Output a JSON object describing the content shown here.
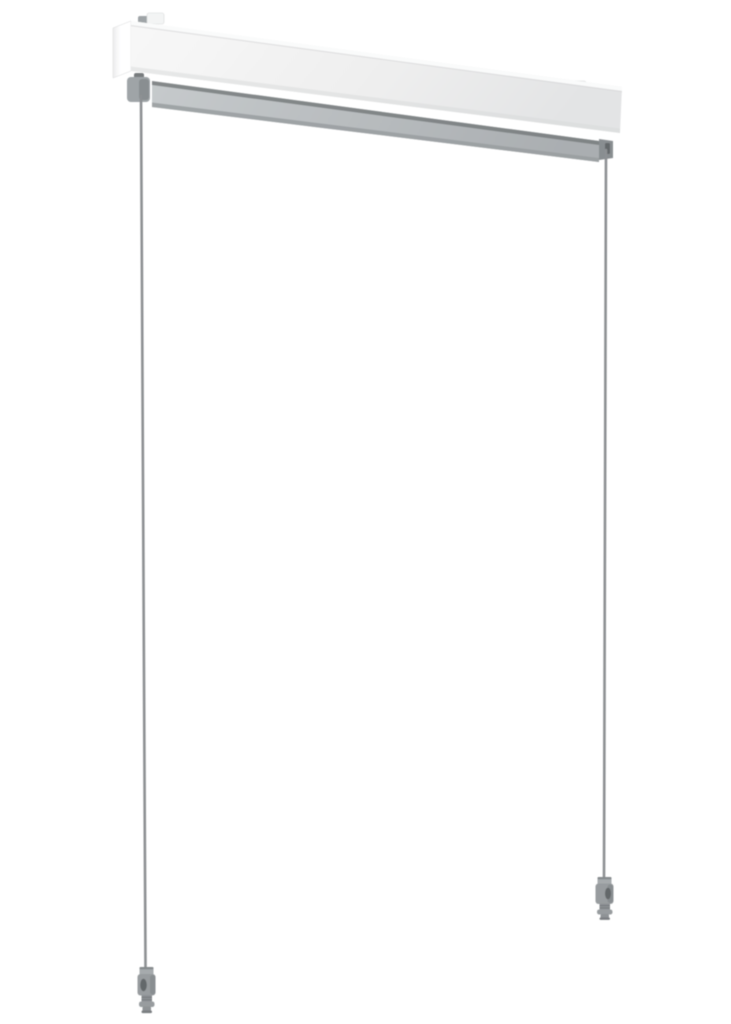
{
  "image": {
    "description": "Product photo of a white roller-blind top cassette with grey bottom rail, two thin tension guide cables hanging down, each ending in a grey cable tensioner fitting",
    "background": "#ffffff"
  },
  "colors": {
    "background": "#ffffff",
    "cassette-front-light": "#f8f8f8",
    "cassette-front-mid": "#efefef",
    "cassette-front-dark": "#e3e4e5",
    "cassette-side-light": "#ffffff",
    "cassette-side-dark": "#ececed",
    "cassette-top-strip": "#fafbfb",
    "cassette-edge": "#d8d9da",
    "tab-white": "#f3f4f4",
    "bar-light": "#c6cacc",
    "bar-dark": "#aaaeb1",
    "bar-shadow": "#787c7e",
    "bar-bottom": "#999da0",
    "bracket": "#9fa4a7",
    "bracket-dark": "#898e91",
    "cable": "#8d9093",
    "weight-collar": "#a6aaad",
    "weight-body": "#989c9f",
    "weight-neck": "#8f9396",
    "weight-slot": "#63676a",
    "weight-tip-end": "#7a7e81"
  }
}
